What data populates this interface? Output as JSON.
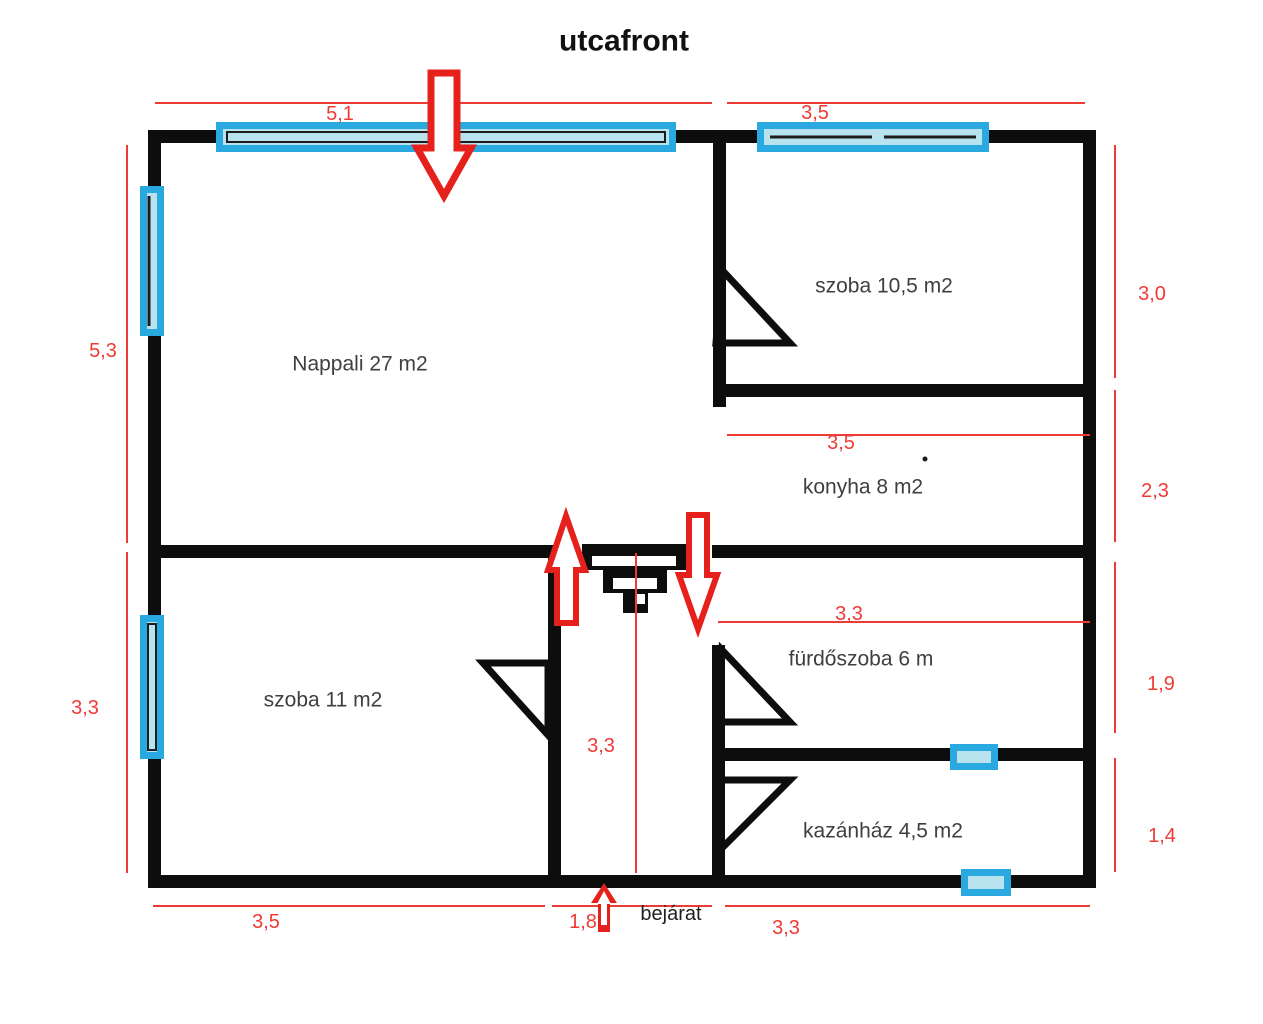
{
  "title": "utcafront",
  "rooms": {
    "nappali": {
      "label": "Nappali 27 m2"
    },
    "szoba_felso": {
      "label": "szoba 10,5 m2"
    },
    "konyha": {
      "label": "konyha 8 m2"
    },
    "szoba_also": {
      "label": "szoba 11 m2"
    },
    "furdoszoba": {
      "label": "fürdőszoba 6 m"
    },
    "kazanhaz": {
      "label": "kazánház 4,5 m2"
    }
  },
  "entrance": {
    "label": "bejárat"
  },
  "dimensions": {
    "top_left_width": "5,1",
    "top_right_width": "3,5",
    "left_upper_height": "5,3",
    "left_lower_height": "3,3",
    "right_szoba_height": "3,0",
    "right_konyha_height": "2,3",
    "right_furdo_height": "1,9",
    "right_kazan_height": "1,4",
    "bottom_left_width": "3,5",
    "bottom_entrance_width": "1,8",
    "bottom_right_width": "3,3",
    "konyha_width": "3,5",
    "furdo_width": "3,3",
    "hall_depth": "3,3"
  },
  "colors": {
    "wall": "#0d0d0d",
    "dim_red": "#ef3b36",
    "arrow_red": "#e6201b",
    "window_border": "#2aa9e0",
    "window_fill": "#b9e2ef",
    "room_label": "#3f3f3f"
  }
}
